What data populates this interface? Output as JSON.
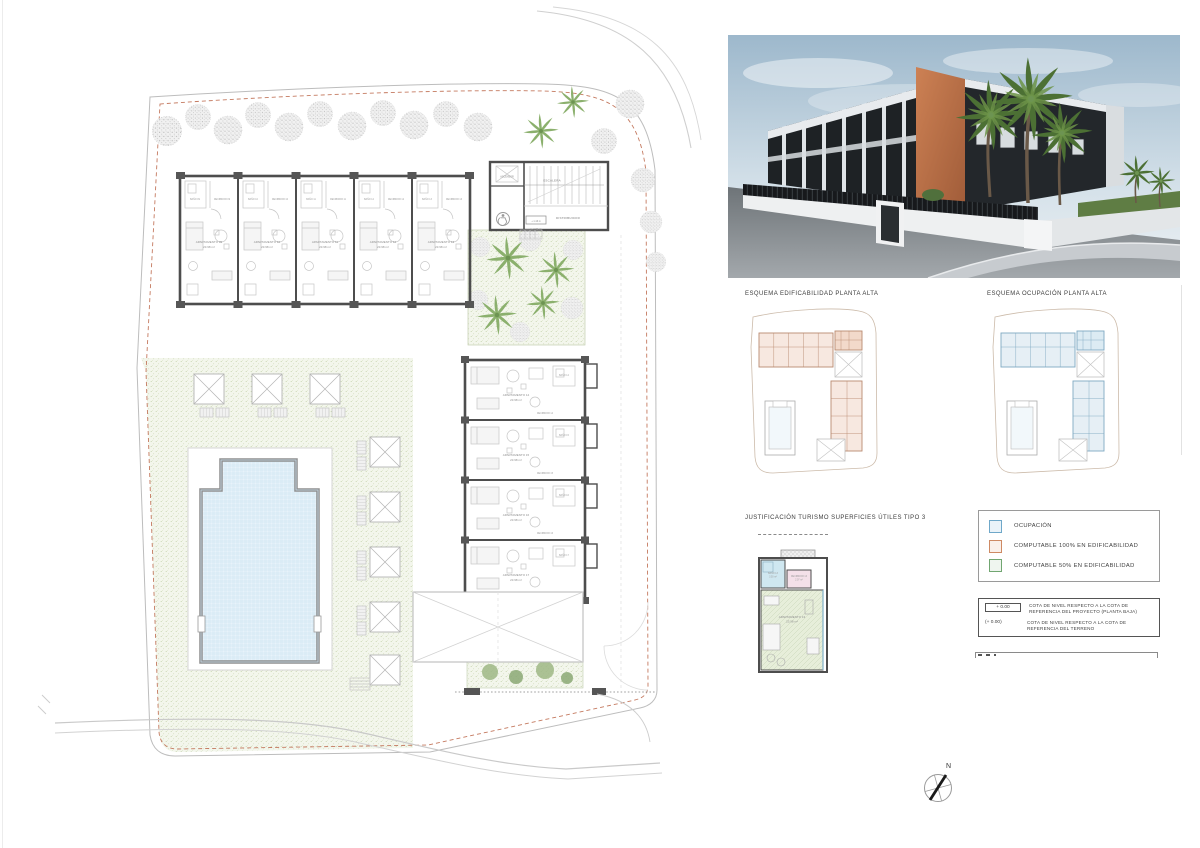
{
  "sheet": {
    "background": "#ffffff"
  },
  "sections": {
    "esquema_edificabilidad_title": "ESQUEMA EDIFICABILIDAD PLANTA ALTA",
    "esquema_ocupacion_title": "ESQUEMA OCUPACIÓN PLANTA ALTA",
    "justificacion_title": "JUSTIFICACIÓN TURISMO SUPERFICIES ÚTILES TIPO 3"
  },
  "legend": {
    "items": [
      {
        "label": "OCUPACIÓN",
        "border": "#6fa8c9",
        "fill": "#eaf3f9"
      },
      {
        "label": "COMPUTABLE 100% EN EDIFICABILIDAD",
        "border": "#ce8a64",
        "fill": "#faf0ea"
      },
      {
        "label": "COMPUTABLE 50% EN EDIFICABILIDAD",
        "border": "#71a671",
        "fill": "#eff5ef"
      }
    ]
  },
  "notes": {
    "rows": [
      {
        "symbol": "+ 0.00",
        "text": "COTA DE NIVEL RESPECTO A LA COTA DE REFERENCIA DEL PROYECTO (PLANTA BAJA)"
      },
      {
        "symbol": "(+ 0.00)",
        "text": "COTA DE NIVEL RESPECTO A LA COTA DE REFERENCIA DEL TERRENO"
      }
    ]
  },
  "compass": {
    "north_label": "N"
  },
  "site_plan": {
    "stairs_label": "ESCALERA",
    "distribuidor_label": "DISTRIBUIDOR",
    "ascensor_label": "ASCENSOR",
    "level_project": "+ 1.16 m",
    "level_terrain": "(+ 1.74 m)",
    "units_top": [
      {
        "name": "APARTAMENTO 09",
        "area": "23.98 m²",
        "bano": "BAÑO 09",
        "recibidor": "RECIBIDOR 09"
      },
      {
        "name": "APARTAMENTO 10",
        "area": "23.98 m²",
        "bano": "BAÑO 10",
        "recibidor": "RECIBIDOR 10"
      },
      {
        "name": "APARTAMENTO 11",
        "area": "23.98 m²",
        "bano": "BAÑO 11",
        "recibidor": "RECIBIDOR 11"
      },
      {
        "name": "APARTAMENTO 12",
        "area": "23.98 m²",
        "bano": "BAÑO 12",
        "recibidor": "RECIBIDOR 12"
      },
      {
        "name": "APARTAMENTO 13",
        "area": "23.98 m²",
        "bano": "BAÑO 13",
        "recibidor": "RECIBIDOR 13"
      }
    ],
    "units_right": [
      {
        "name": "APARTAMENTO 14",
        "area": "23.98 m²",
        "bano": "BAÑO 14",
        "recibidor": "RECIBIDOR 14"
      },
      {
        "name": "APARTAMENTO 15",
        "area": "23.98 m²",
        "bano": "BAÑO 15",
        "recibidor": "RECIBIDOR 15"
      },
      {
        "name": "APARTAMENTO 16",
        "area": "23.98 m²",
        "bano": "BAÑO 16",
        "recibidor": "RECIBIDOR 16"
      },
      {
        "name": "APARTAMENTO 17",
        "area": "23.98 m²",
        "bano": "BAÑO 17",
        "recibidor": "RECIBIDOR 17"
      }
    ]
  },
  "detail_unit": {
    "bano": {
      "name": "BAÑO 13",
      "area": "3.50 m²"
    },
    "recibidor": {
      "name": "RECIBIDOR 13",
      "area": "2.07 m²"
    },
    "apartamento": {
      "name": "APARTAMENTO 13",
      "area": "23.98 m²"
    }
  }
}
